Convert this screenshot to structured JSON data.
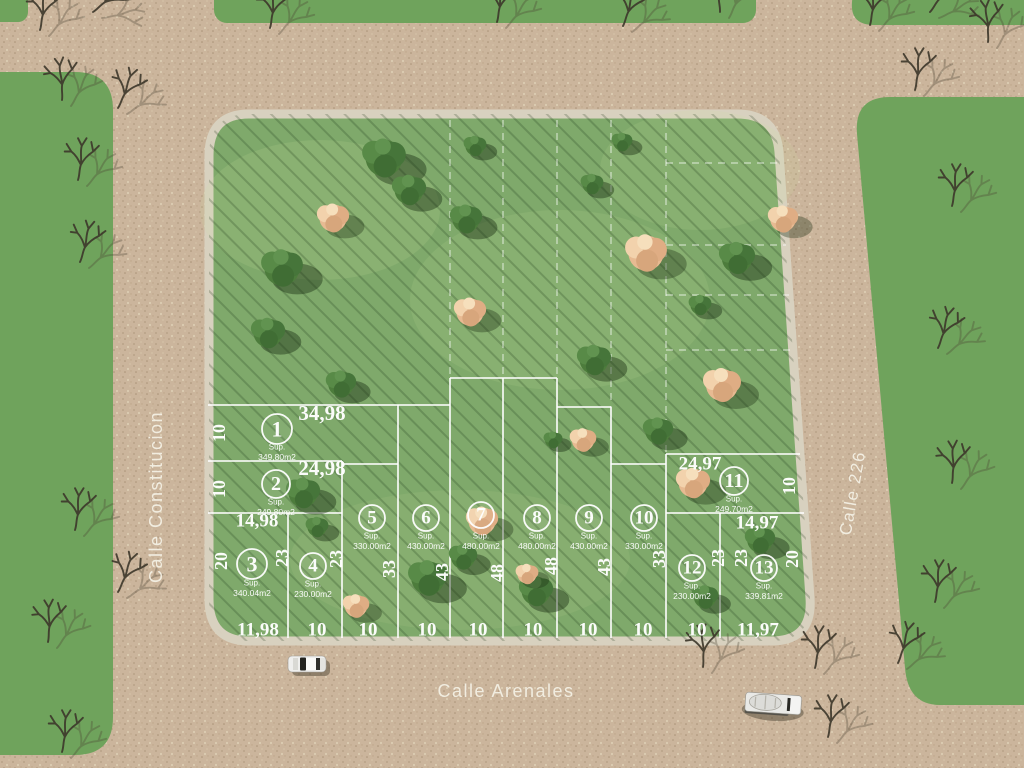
{
  "streets": {
    "left": "Calle Constitucion",
    "bottom": "Calle Arenales",
    "right": "Calle 226"
  },
  "colors": {
    "road": "#cbb59c",
    "grass_block": "#7fa96b",
    "grass_strip": "#6fa35c",
    "sidewalk": "#d8d1bf",
    "lot_line": "#ffffff",
    "tree_green": "#4d7c3c",
    "tree_flower": "#eabd94",
    "street_text": "#f4f0e4"
  },
  "lots": [
    {
      "num": "1",
      "sup": "Sup.",
      "area": "349,80m2",
      "cx": 277,
      "cy": 429,
      "r": 15,
      "ty": 447
    },
    {
      "num": "2",
      "sup": "Sup.",
      "area": "249,80m2",
      "cx": 276,
      "cy": 484,
      "r": 14,
      "ty": 502
    },
    {
      "num": "3",
      "sup": "Sup.",
      "area": "340.04m2",
      "cx": 252,
      "cy": 564,
      "r": 15,
      "ty": 583
    },
    {
      "num": "4",
      "sup": "Sup.",
      "area": "230.00m2",
      "cx": 313,
      "cy": 566,
      "r": 13,
      "ty": 584
    },
    {
      "num": "5",
      "sup": "Sup.",
      "area": "330.00m2",
      "cx": 372,
      "cy": 518,
      "r": 13,
      "ty": 536
    },
    {
      "num": "6",
      "sup": "Sup.",
      "area": "430.00m2",
      "cx": 426,
      "cy": 518,
      "r": 13,
      "ty": 536
    },
    {
      "num": "7",
      "sup": "Sup.",
      "area": "480.00m2",
      "cx": 481,
      "cy": 515,
      "r": 13,
      "ty": 536
    },
    {
      "num": "8",
      "sup": "Sup.",
      "area": "480.00m2",
      "cx": 537,
      "cy": 518,
      "r": 13,
      "ty": 536
    },
    {
      "num": "9",
      "sup": "Sup.",
      "area": "430.00m2",
      "cx": 589,
      "cy": 518,
      "r": 13,
      "ty": 536
    },
    {
      "num": "10",
      "sup": "Sup.",
      "area": "330.00m2",
      "cx": 644,
      "cy": 518,
      "r": 13,
      "ty": 536
    },
    {
      "num": "11",
      "sup": "Sup.",
      "area": "249.70m2",
      "cx": 734,
      "cy": 481,
      "r": 14,
      "ty": 499
    },
    {
      "num": "12",
      "sup": "Sup.",
      "area": "230.00m2",
      "cx": 692,
      "cy": 568,
      "r": 13,
      "ty": 586
    },
    {
      "num": "13",
      "sup": "Sup.",
      "area": "339.81m2",
      "cx": 764,
      "cy": 568,
      "r": 13,
      "ty": 586
    }
  ],
  "dims": [
    {
      "t": "34,98",
      "x": 322,
      "y": 413,
      "r": 0,
      "s": 21
    },
    {
      "t": "24,98",
      "x": 322,
      "y": 468,
      "r": 0,
      "s": 21
    },
    {
      "t": "14,98",
      "x": 257,
      "y": 521,
      "r": 0,
      "s": 19
    },
    {
      "t": "24,97",
      "x": 700,
      "y": 464,
      "r": 0,
      "s": 19
    },
    {
      "t": "14,97",
      "x": 757,
      "y": 523,
      "r": 0,
      "s": 19
    },
    {
      "t": "11,98",
      "x": 258,
      "y": 630,
      "r": 0,
      "s": 19
    },
    {
      "t": "10",
      "x": 317,
      "y": 630,
      "r": 0,
      "s": 19
    },
    {
      "t": "10",
      "x": 368,
      "y": 630,
      "r": 0,
      "s": 19
    },
    {
      "t": "10",
      "x": 427,
      "y": 630,
      "r": 0,
      "s": 19
    },
    {
      "t": "10",
      "x": 478,
      "y": 630,
      "r": 0,
      "s": 19
    },
    {
      "t": "10",
      "x": 533,
      "y": 630,
      "r": 0,
      "s": 19
    },
    {
      "t": "10",
      "x": 588,
      "y": 630,
      "r": 0,
      "s": 19
    },
    {
      "t": "10",
      "x": 643,
      "y": 630,
      "r": 0,
      "s": 19
    },
    {
      "t": "10",
      "x": 697,
      "y": 630,
      "r": 0,
      "s": 19
    },
    {
      "t": "11,97",
      "x": 758,
      "y": 630,
      "r": 0,
      "s": 19
    },
    {
      "t": "10",
      "x": 219,
      "y": 433,
      "r": -90,
      "s": 18
    },
    {
      "t": "10",
      "x": 219,
      "y": 489,
      "r": -90,
      "s": 18
    },
    {
      "t": "20",
      "x": 221,
      "y": 561,
      "r": -90,
      "s": 18
    },
    {
      "t": "23",
      "x": 282,
      "y": 558,
      "r": -90,
      "s": 18
    },
    {
      "t": "23",
      "x": 336,
      "y": 559,
      "r": -90,
      "s": 18
    },
    {
      "t": "33",
      "x": 389,
      "y": 569,
      "r": -90,
      "s": 18
    },
    {
      "t": "43",
      "x": 442,
      "y": 572,
      "r": -90,
      "s": 18
    },
    {
      "t": "48",
      "x": 497,
      "y": 573,
      "r": -90,
      "s": 18
    },
    {
      "t": "48",
      "x": 551,
      "y": 566,
      "r": -90,
      "s": 18
    },
    {
      "t": "43",
      "x": 604,
      "y": 567,
      "r": -90,
      "s": 18
    },
    {
      "t": "33",
      "x": 659,
      "y": 559,
      "r": -90,
      "s": 18
    },
    {
      "t": "23",
      "x": 718,
      "y": 558,
      "r": -90,
      "s": 18
    },
    {
      "t": "23",
      "x": 741,
      "y": 558,
      "r": -90,
      "s": 18
    },
    {
      "t": "20",
      "x": 792,
      "y": 559,
      "r": -90,
      "s": 18
    },
    {
      "t": "10",
      "x": 789,
      "y": 486,
      "r": -90,
      "s": 18
    }
  ],
  "lines_solid": [
    [
      208,
      405,
      450,
      405
    ],
    [
      208,
      461,
      342,
      461
    ],
    [
      342,
      464,
      398,
      464
    ],
    [
      450,
      378,
      557,
      378
    ],
    [
      557,
      407,
      611,
      407
    ],
    [
      611,
      464,
      666,
      464
    ],
    [
      208,
      513,
      342,
      513
    ],
    [
      666,
      454,
      800,
      454
    ],
    [
      666,
      513,
      804,
      513
    ],
    [
      398,
      405,
      398,
      638
    ],
    [
      342,
      461,
      342,
      638
    ],
    [
      288,
      513,
      288,
      638
    ],
    [
      450,
      378,
      450,
      638
    ],
    [
      503,
      378,
      503,
      638
    ],
    [
      557,
      378,
      557,
      638
    ],
    [
      611,
      407,
      611,
      638
    ],
    [
      666,
      454,
      666,
      638
    ],
    [
      720,
      513,
      720,
      638
    ]
  ],
  "lines_dashed": [
    [
      450,
      120,
      450,
      378
    ],
    [
      503,
      120,
      503,
      378
    ],
    [
      557,
      120,
      557,
      378
    ],
    [
      611,
      120,
      611,
      407
    ],
    [
      666,
      120,
      666,
      454
    ],
    [
      666,
      163,
      780,
      163
    ],
    [
      666,
      245,
      786,
      245
    ],
    [
      666,
      295,
      789,
      295
    ],
    [
      666,
      350,
      793,
      350
    ]
  ],
  "trees_green": [
    [
      282,
      268,
      1.1
    ],
    [
      268,
      333,
      0.9
    ],
    [
      341,
      384,
      0.8
    ],
    [
      384,
      158,
      1.15
    ],
    [
      409,
      190,
      0.9
    ],
    [
      466,
      219,
      0.85
    ],
    [
      592,
      184,
      0.6
    ],
    [
      737,
      258,
      0.95
    ],
    [
      594,
      360,
      0.9
    ],
    [
      658,
      431,
      0.8
    ],
    [
      303,
      493,
      0.9
    ],
    [
      428,
      578,
      1.05
    ],
    [
      463,
      557,
      0.75
    ],
    [
      536,
      591,
      0.9
    ],
    [
      760,
      540,
      0.8
    ],
    [
      622,
      142,
      0.55
    ],
    [
      700,
      305,
      0.6
    ],
    [
      553,
      440,
      0.5
    ],
    [
      475,
      146,
      0.6
    ],
    [
      705,
      597,
      0.7
    ],
    [
      317,
      527,
      0.6
    ]
  ],
  "trees_flower": [
    [
      333,
      218,
      0.85
    ],
    [
      646,
      253,
      1.1
    ],
    [
      470,
      312,
      0.85
    ],
    [
      722,
      385,
      1.0
    ],
    [
      583,
      440,
      0.7
    ],
    [
      356,
      606,
      0.7
    ],
    [
      482,
      521,
      0.85
    ],
    [
      693,
      483,
      0.9
    ],
    [
      527,
      574,
      0.6
    ],
    [
      783,
      219,
      0.8
    ]
  ],
  "trees_dead": [
    [
      40,
      30,
      0
    ],
    [
      93,
      12,
      40
    ],
    [
      62,
      100,
      -10
    ],
    [
      118,
      108,
      15
    ],
    [
      78,
      180,
      0
    ],
    [
      80,
      262,
      8
    ],
    [
      75,
      530,
      0
    ],
    [
      118,
      592,
      15
    ],
    [
      48,
      642,
      -5
    ],
    [
      62,
      752,
      0
    ],
    [
      270,
      28,
      0
    ],
    [
      497,
      22,
      0
    ],
    [
      623,
      26,
      10
    ],
    [
      720,
      12,
      -15
    ],
    [
      870,
      25,
      0
    ],
    [
      930,
      12,
      25
    ],
    [
      988,
      42,
      -10
    ],
    [
      915,
      90,
      0
    ],
    [
      952,
      206,
      0
    ],
    [
      938,
      348,
      10
    ],
    [
      952,
      483,
      -5
    ],
    [
      935,
      602,
      0
    ],
    [
      898,
      663,
      10
    ],
    [
      815,
      668,
      0
    ],
    [
      703,
      667,
      -8
    ],
    [
      828,
      737,
      0
    ]
  ],
  "vehicles": [
    {
      "type": "car",
      "x": 288,
      "y": 656,
      "rot": 0
    },
    {
      "type": "truck",
      "x": 746,
      "y": 692,
      "rot": 4
    }
  ]
}
